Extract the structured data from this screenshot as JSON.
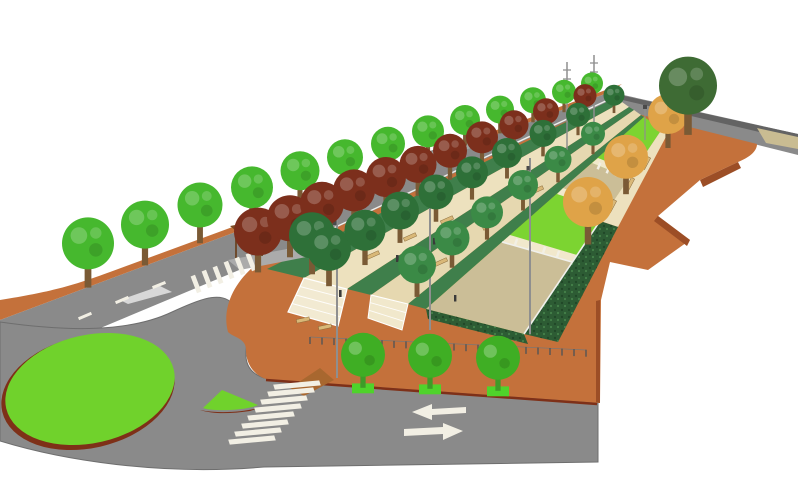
{
  "scene": {
    "type": "3d-landscape-render",
    "description": "Aerial perspective rendering of a linear park boulevard with a roundabout, tree rows, lawn panels, stepped terraces, hedges, a plaza esplanade and road markings",
    "roundabout": {
      "island_shape": "green oval with dark red curb",
      "splitter_island": "green triangle with dark red curb"
    },
    "road_markings": {
      "arrows": [
        "left",
        "right"
      ],
      "crosswalks": 2,
      "center_line": "dashed white",
      "edge_line": "white"
    },
    "vegetation": {
      "street_trees": 13,
      "red_leaf_trees": 11,
      "park_trees_dark": 16,
      "autumn_trees": 3,
      "plaza_trees": 3,
      "corner_tree": 1,
      "hedges": "L-shaped dark hedge around sand court"
    },
    "furniture": {
      "benches": 13,
      "light_masts": 5,
      "small_lamps": 1,
      "shelters": 2,
      "fence_posts": 24
    }
  },
  "colors": {
    "road": "#8A8A8A",
    "road_far": "#636363",
    "road_edge": "#5E5E5E",
    "marking": "#F2EFE4",
    "sidewalk": "#C4713B",
    "esplanade": "#C4713B",
    "esplanade_side": "#9C4E26",
    "connector": "#A8672F",
    "curb": "#7E3018",
    "island_green": "#70D22C",
    "lawn": "#7CD431",
    "band_green": "#3F7F4B",
    "path_beige": "#EDE1BE",
    "path_beige2": "#E6D8B0",
    "sand": "#CBBE97",
    "cream": "#F1E8CC",
    "stair": "#F2EAD2",
    "hedge": "#2D5C34",
    "tree_street": "#46B82E",
    "tree_dark": "#2E7038",
    "tree_dark2": "#3B8A46",
    "tree_maroon": "#7C2F1C",
    "tree_autumn": "#DFA348",
    "tree_big": "#3E6B34",
    "tree_small": "#3FAE24",
    "shelter_roof": "#7B4A22",
    "shelter_front": "#5E3517",
    "platform": "#ABABAB",
    "platform2": "#9FA5A3",
    "pole": "#8F8F8F",
    "bench": "#D9B878",
    "fence": "#555555",
    "white_edge": "#F0F0EC",
    "tan_walk": "#C9BC92"
  }
}
